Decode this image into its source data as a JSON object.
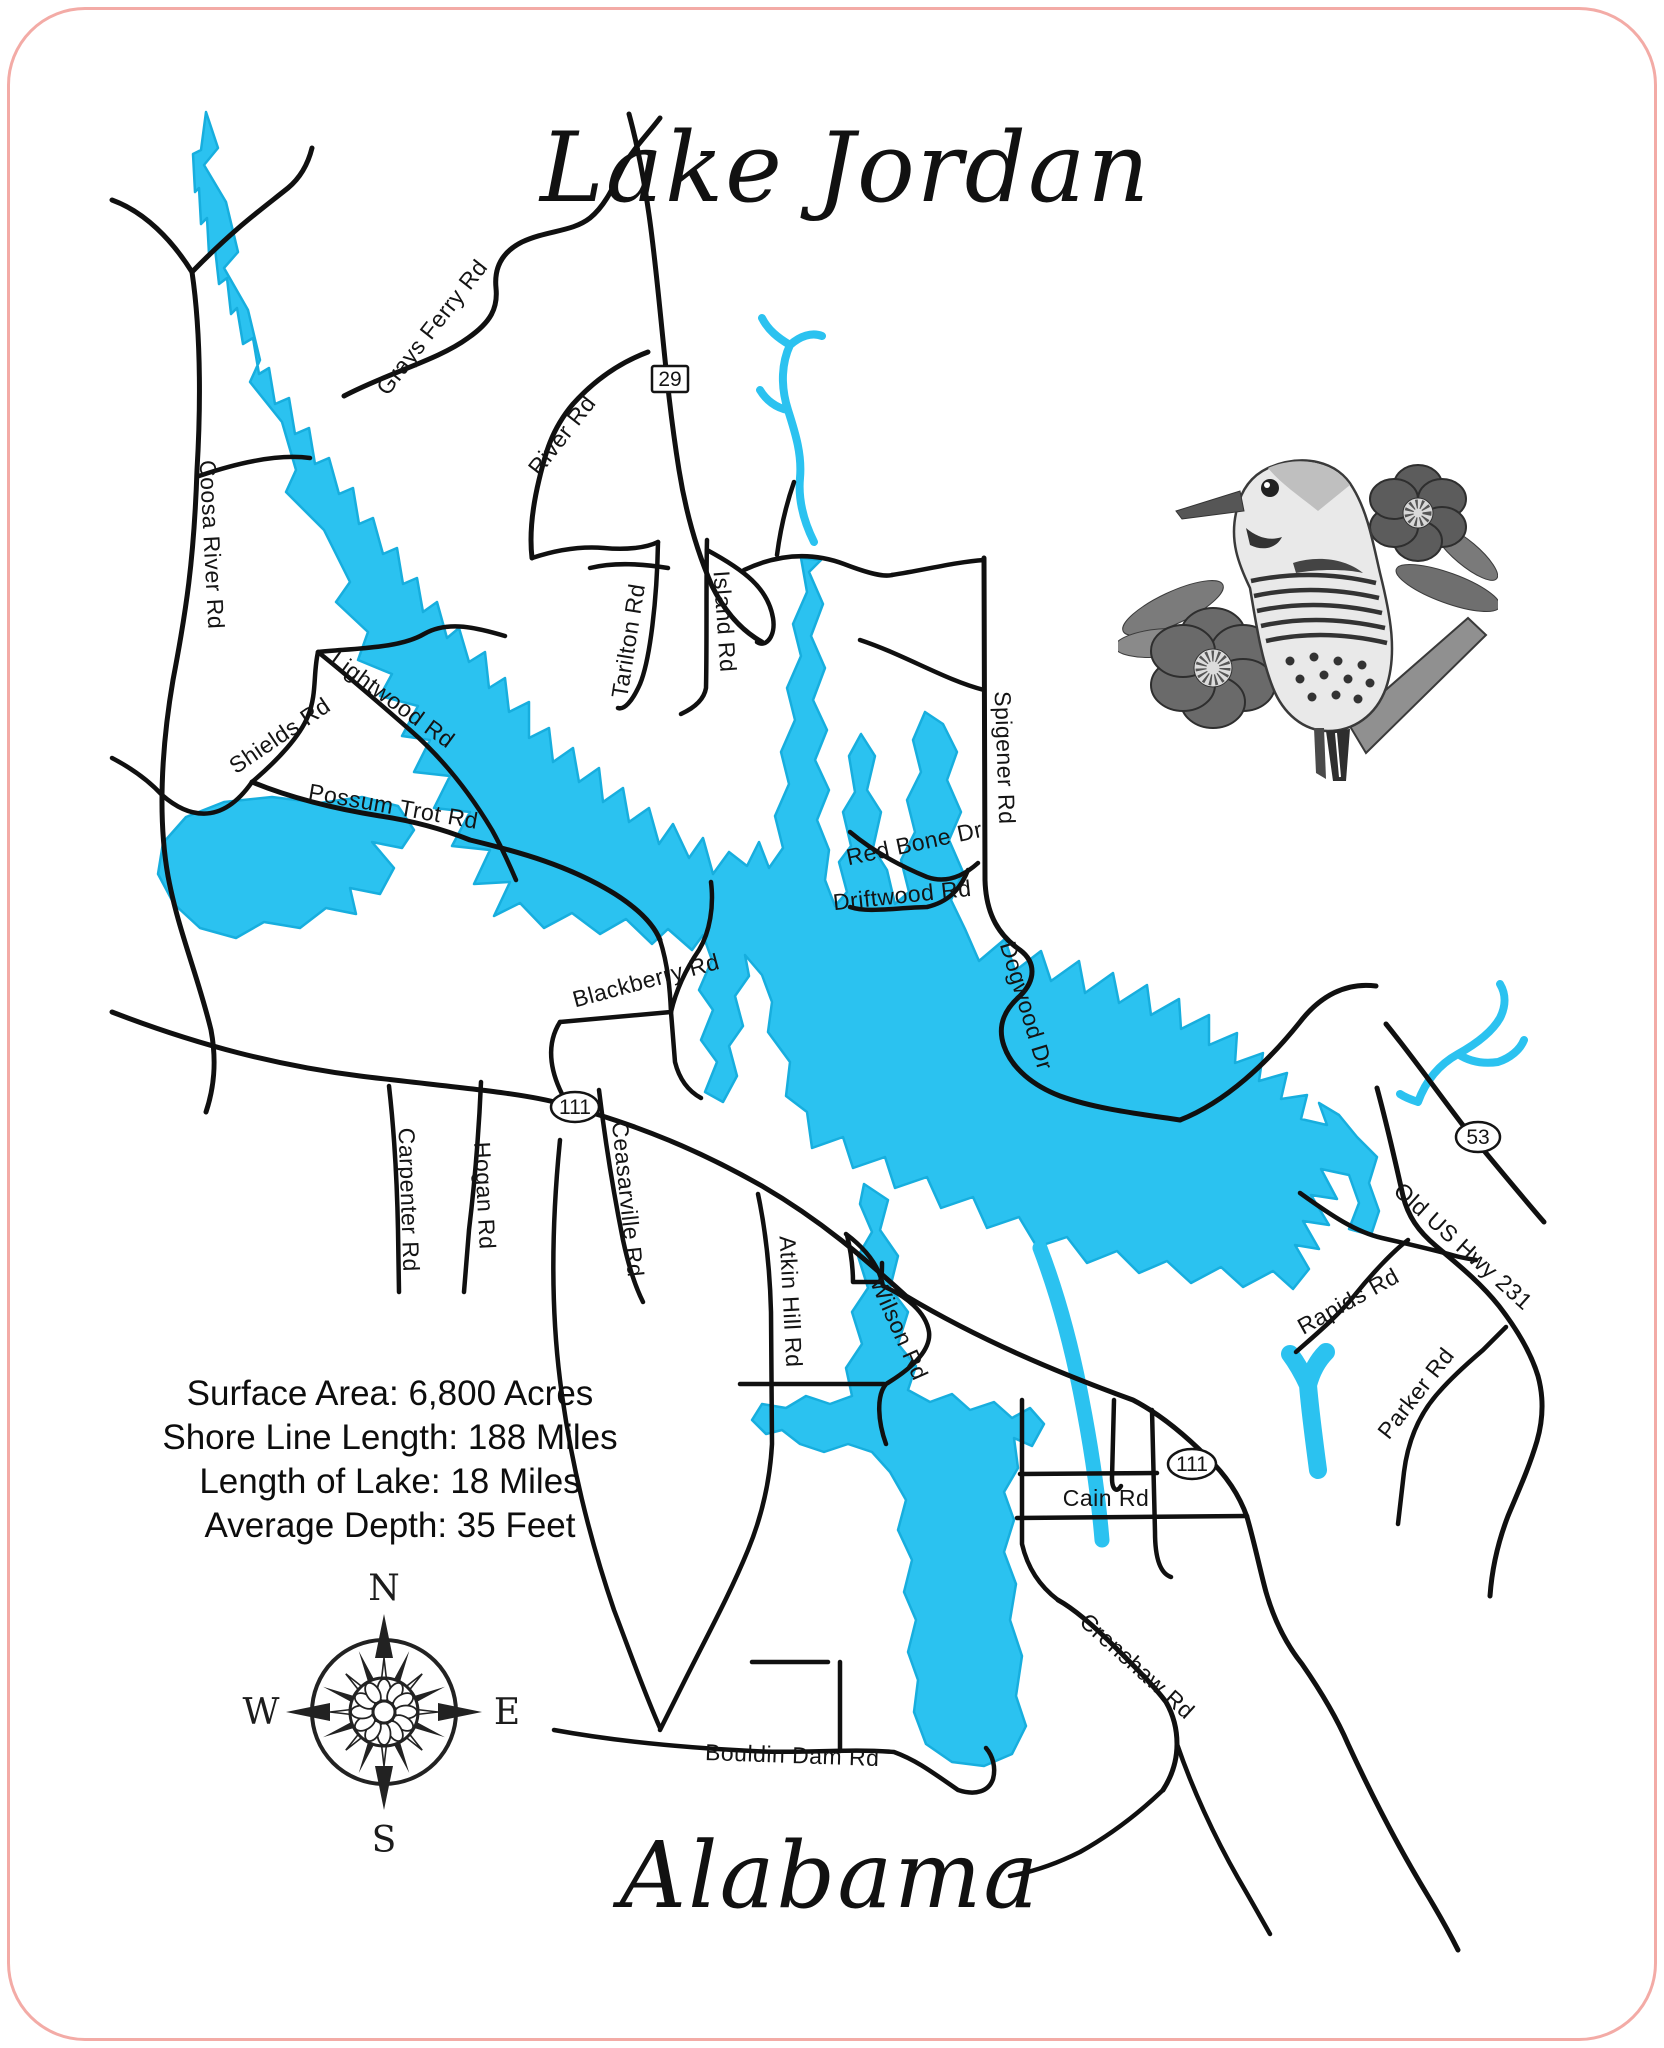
{
  "title": "Lake Jordan",
  "state_label": "Alabama",
  "stats": {
    "lines": [
      "Surface Area: 6,800 Acres",
      "Shore Line Length: 188 Miles",
      "Length of Lake: 18 Miles",
      "Average Depth: 35 Feet"
    ]
  },
  "compass": {
    "n": "N",
    "s": "S",
    "e": "E",
    "w": "W"
  },
  "colors": {
    "lake": "#2bc2f0",
    "road": "#101010",
    "border": "#f3aba6"
  },
  "roads": {
    "grays_ferry": "Grays Ferry Rd",
    "river": "River Rd",
    "coosa_river": "Coosa River Rd",
    "shields": "Shields Rd",
    "lightwood": "Lightwood Rd",
    "possum_trot": "Possum Trot Rd",
    "tarilton": "Tarilton Rd",
    "island": "Island Rd",
    "spigener": "Spigener Rd",
    "red_bone": "Red Bone Dr",
    "driftwood": "Driftwood Rd",
    "dogwood": "Dogwood Dr",
    "blackberry": "Blackberry Rd",
    "carpenter": "Carpenter Rd",
    "hogan": "Hogan Rd",
    "ceasarville": "Ceasarville Rd",
    "atkin_hill": "Atkin Hill Rd",
    "wilson": "Wilson Rd",
    "rapids": "Rapids Rd",
    "old_us_hwy_231": "Old US Hwy 231",
    "parker": "Parker Rd",
    "cain": "Cain Rd",
    "crenshaw": "Crenshaw Rd",
    "bouldin_dam": "Bouldin Dam Rd"
  },
  "shields": {
    "hwy29": "29",
    "hwy111_west": "111",
    "hwy53": "53",
    "hwy111_east": "111"
  }
}
